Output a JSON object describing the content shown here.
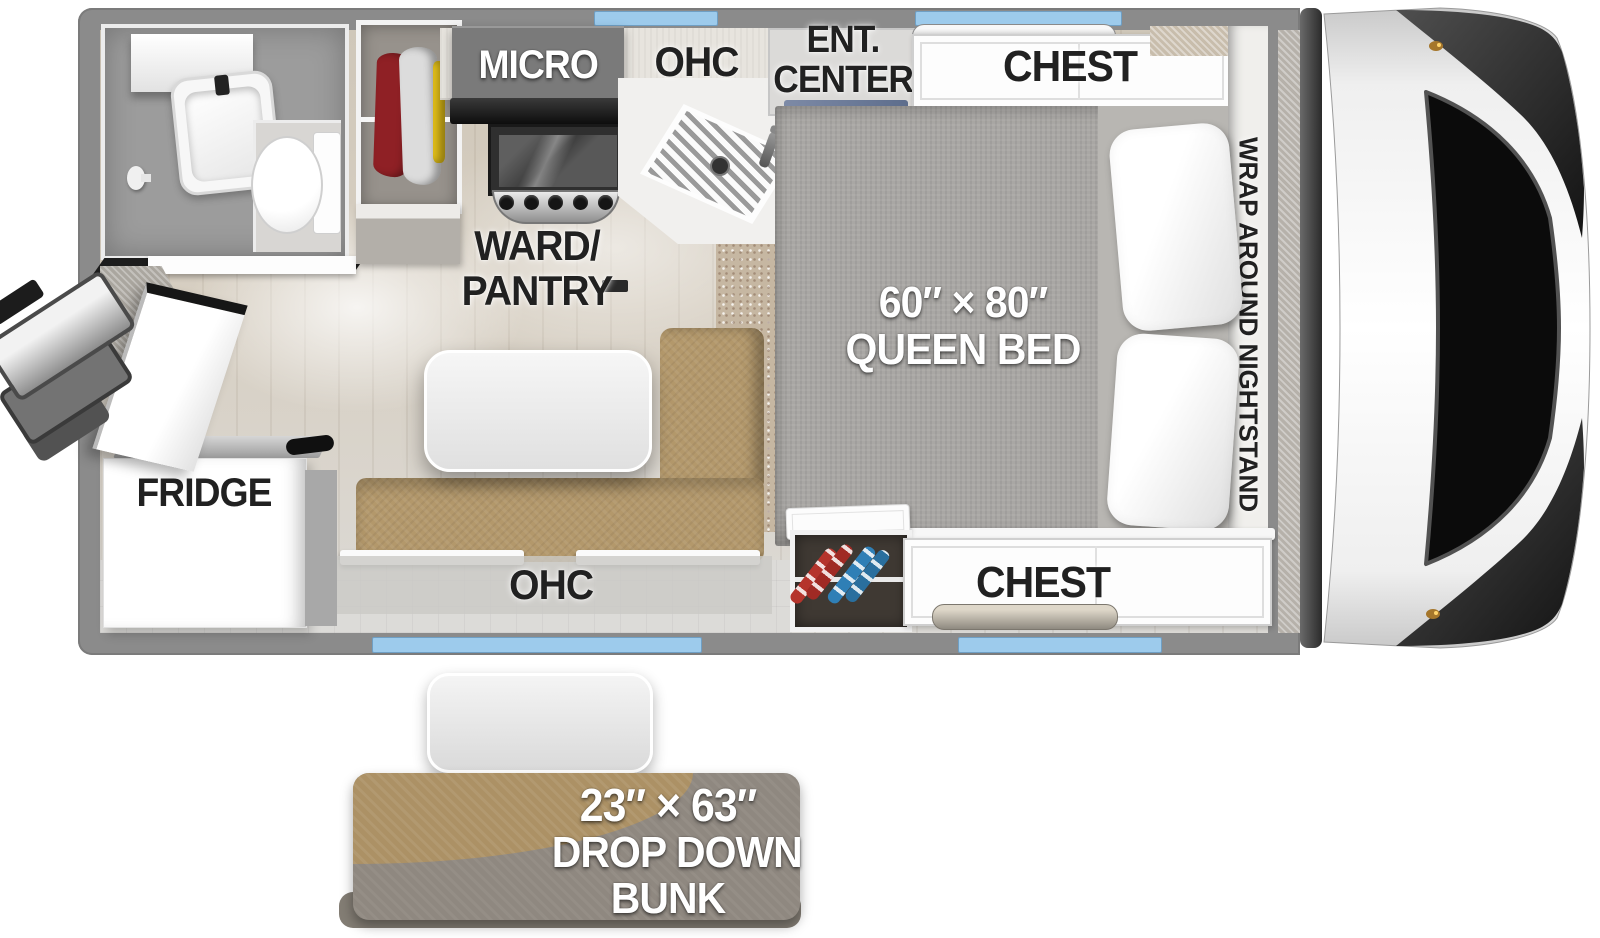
{
  "title": "Truck Camper Floorplan",
  "labels": {
    "micro": "MICRO",
    "kitchen_ohc": "OHC",
    "ent_line1": "ENT.",
    "ent_line2": "CENTER",
    "chest_front": "CHEST",
    "chest_rear": "CHEST",
    "nightstand": "WRAP AROUND NIGHTSTAND",
    "bed_size": "60″ × 80″",
    "bed_name": "QUEEN BED",
    "ward_line1": "WARD/",
    "ward_line2": "PANTRY",
    "fridge": "FRIDGE",
    "dinette_ohc": "OHC",
    "bunk_size": "23″ × 63″",
    "bunk_line1": "DROP DOWN",
    "bunk_line2": "BUNK"
  },
  "colors": {
    "wall": "#8B8B8B",
    "floor": "#D7CFC2",
    "window_glass": "#9DCBEC",
    "bed_fabric": "#A9A7A4",
    "pillow": "#FFFFFF",
    "dinette_leather": "#B3986B",
    "carpet": "#C6B7A2",
    "bunk_tan": "#AC9165",
    "bunk_gray": "#8F8880",
    "clothes_red": "#8F2025",
    "clothes_yellow": "#E3C019",
    "shoe_red": "#B5342C",
    "shoe_blue": "#2F7FB6",
    "tv_accent": "#7D8AA6",
    "label_dark": "#212121",
    "label_light": "#FFFFFF"
  }
}
